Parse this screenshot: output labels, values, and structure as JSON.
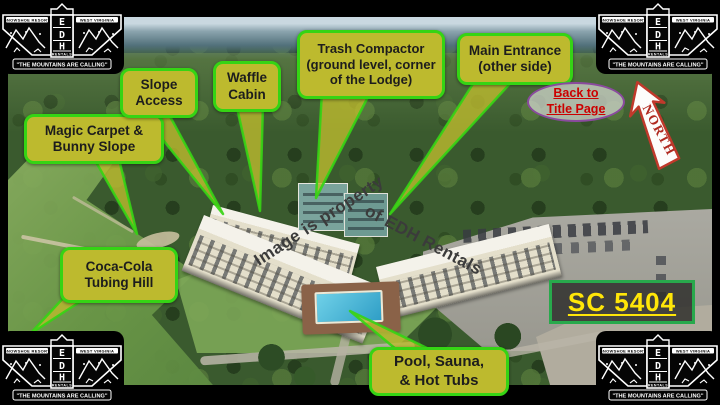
{
  "logo": {
    "left_banner": "SNOWSHOE RESORT",
    "right_banner": "WEST VIRGINIA",
    "letters": [
      "E",
      "D",
      "H"
    ],
    "rentals": "RENTALS",
    "tagline": "\"THE MOUNTAINS ARE CALLING\""
  },
  "callouts": {
    "magic_carpet": "Magic Carpet &\nBunny Slope",
    "slope_access": "Slope\nAccess",
    "waffle_cabin": "Waffle\nCabin",
    "trash_compactor": "Trash Compactor\n(ground level, corner\nof the Lodge)",
    "main_entrance": "Main Entrance\n(other side)",
    "tubing_hill": "Coca-Cola\nTubing Hill",
    "pool": "Pool, Sauna,\n& Hot Tubs"
  },
  "links": {
    "back_to_title": "Back to\nTitle Page"
  },
  "compass": {
    "label": "NORTH"
  },
  "unit_badge": {
    "label": "SC 5404"
  },
  "watermark": {
    "part1": "Image is property",
    "part2": "of EDH Rentals"
  },
  "colors": {
    "callout_bg": "#bdba2e",
    "callout_border": "#35d414",
    "callout_text": "#1d1d1d",
    "back_link_text": "#cc0000",
    "back_link_border": "#8a4a9e",
    "north_red": "#b02a20",
    "unit_text": "#ffe608",
    "unit_border": "#28a94c"
  }
}
